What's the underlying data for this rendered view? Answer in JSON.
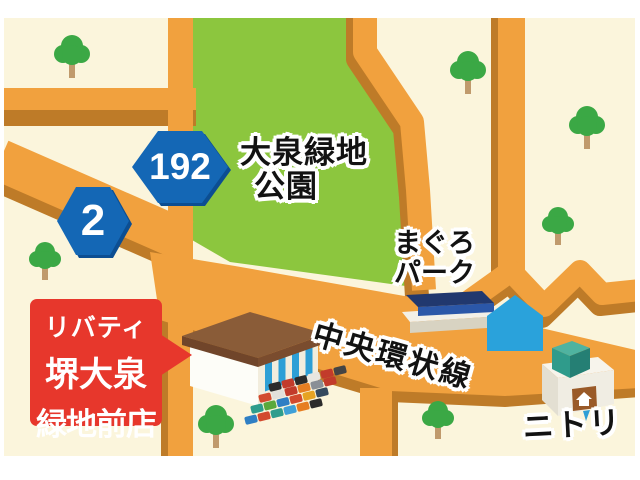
{
  "labels": {
    "park": {
      "line1": "大泉緑地",
      "line2": "公園"
    },
    "maguro_park": {
      "line1": "まぐろ",
      "line2": "パーク"
    },
    "road_name": "中央環状線",
    "nitori": "ニトリ",
    "store_sign": {
      "line1": "リバティ",
      "line2": "堺大泉",
      "line3": "緑地前店"
    }
  },
  "shields": [
    {
      "number": "192"
    },
    {
      "number": "2"
    }
  ],
  "landmarks": [
    "store-building",
    "parked-cars",
    "maguro-park-building",
    "blue-pentagon-landmark",
    "nitori-building",
    "trees",
    "route-shields"
  ],
  "colors": {
    "map_background": "#FBF5DC",
    "park_green": "#8CC63E",
    "road_orange": "#F1A13E",
    "road_shadow": "#BE7B28",
    "shield_blue": "#1467B5",
    "sign_red": "#E7372C",
    "tree_green": "#3BA845",
    "landmark_blue": "#2AA2DB",
    "label_text": "#121212"
  }
}
